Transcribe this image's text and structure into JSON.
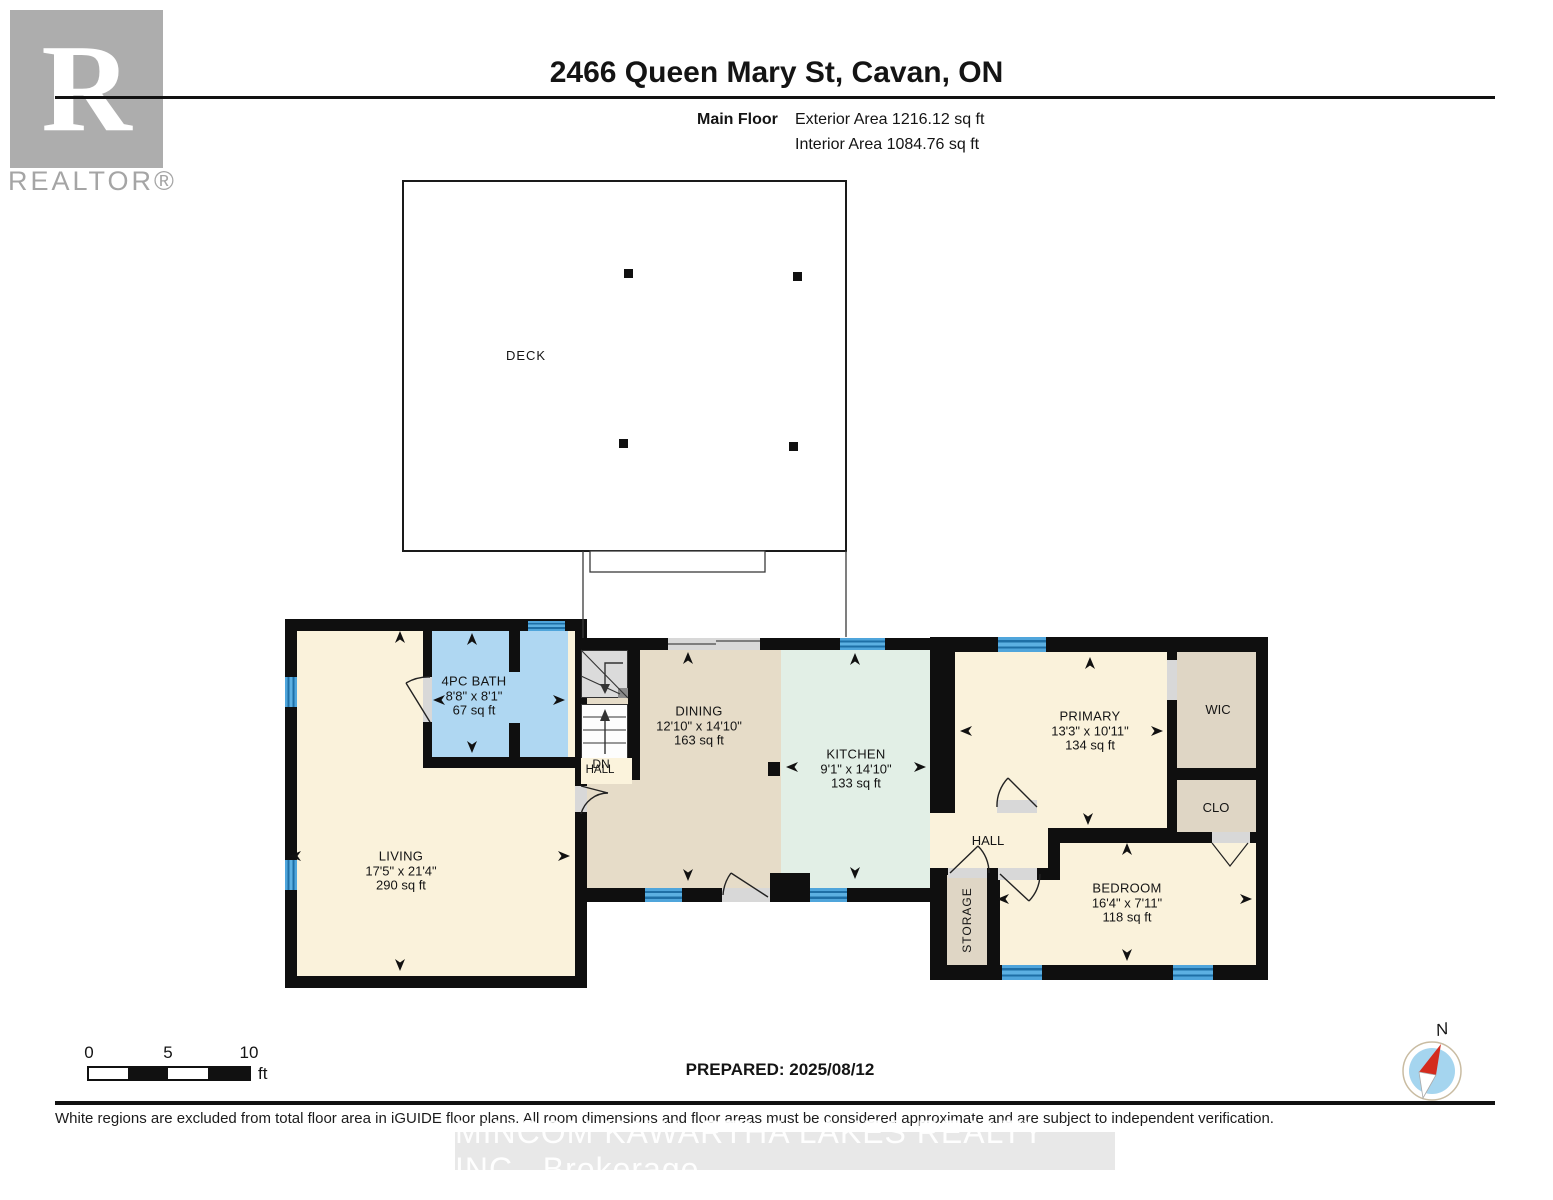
{
  "header": {
    "title": "2466 Queen Mary St, Cavan, ON",
    "floor_label": "Main Floor",
    "exterior_area": "Exterior Area 1216.12 sq ft",
    "interior_area": "Interior Area 1084.76 sq ft"
  },
  "logo": {
    "letter": "R",
    "brand": "REALTOR®"
  },
  "rooms": {
    "deck": {
      "name": "DECK"
    },
    "bath": {
      "name": "4PC BATH",
      "dims": "8'8\" x 8'1\"",
      "area": "67 sq ft"
    },
    "living": {
      "name": "LIVING",
      "dims": "17'5\" x 21'4\"",
      "area": "290 sq ft"
    },
    "dining": {
      "name": "DINING",
      "dims": "12'10\" x 14'10\"",
      "area": "163 sq ft"
    },
    "kitchen": {
      "name": "KITCHEN",
      "dims": "9'1\" x 14'10\"",
      "area": "133 sq ft"
    },
    "primary": {
      "name": "PRIMARY",
      "dims": "13'3\" x 10'11\"",
      "area": "134 sq ft"
    },
    "wic": {
      "name": "WIC"
    },
    "clo": {
      "name": "CLO"
    },
    "hall": {
      "name": "HALL"
    },
    "stair_hall": {
      "name": "HALL",
      "dn": "DN"
    },
    "storage": {
      "name": "STORAGE"
    },
    "bedroom": {
      "name": "BEDROOM",
      "dims": "16'4\" x 7'11\"",
      "area": "118 sq ft"
    }
  },
  "scale_bar": {
    "t0": "0",
    "t5": "5",
    "t10": "10",
    "unit": "ft"
  },
  "prepared": "PREPARED: 2025/08/12",
  "compass": {
    "label": "N"
  },
  "footer": {
    "disclaimer": "White regions are excluded from total floor area in iGUIDE floor plans. All room dimensions and floor areas must be considered approximate and are subject to independent verification.",
    "watermark": "MINCOM KAWARTHA LAKES REALTY INC.,  Brokerage"
  },
  "colors": {
    "wall": "#0f0f0f",
    "room_cream": "#FAF2DB",
    "room_blue": "#AFD7F2",
    "room_tan": "#E6DCC8",
    "room_green": "#E2EFE6",
    "room_beige": "#DFD6C5",
    "window_blue": "#4FA5DB",
    "window_stripe": "#1E6FA6",
    "threshold": "#D8D8D8",
    "logo_gray": "#ADADAD",
    "compass_blue": "#A5D5EF",
    "compass_red": "#D42B1E"
  }
}
